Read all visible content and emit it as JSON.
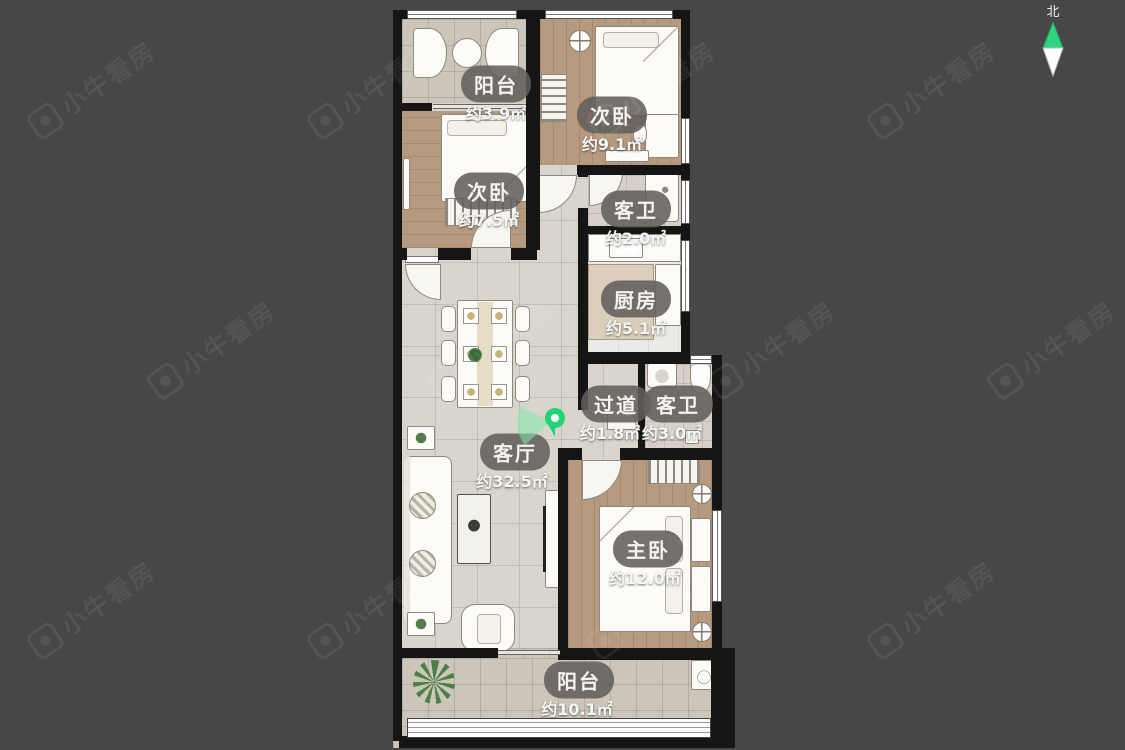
{
  "app": {
    "watermark_text": "小牛看房",
    "north_label": "北"
  },
  "rooms": {
    "balcony_top": {
      "label": "阳台",
      "area": "约3.9㎡"
    },
    "bedroom_top": {
      "label": "次卧",
      "area": "约9.1㎡"
    },
    "bedroom_left": {
      "label": "次卧",
      "area": "约7.5㎡"
    },
    "bath_top": {
      "label": "客卫",
      "area": "约2.0㎡"
    },
    "kitchen": {
      "label": "厨房",
      "area": "约5.1㎡"
    },
    "hallway": {
      "label": "过道",
      "area": "约1.8㎡"
    },
    "bath_mid": {
      "label": "客卫",
      "area": "约3.0㎡"
    },
    "living": {
      "label": "客厅",
      "area": "约32.5㎡"
    },
    "master": {
      "label": "主卧",
      "area": "约12.0㎡"
    },
    "balcony_bottom": {
      "label": "阳台",
      "area": "约10.1㎡"
    }
  },
  "colors": {
    "background": "#474747",
    "wall": "#151515",
    "wood_floor": "#b69a7f",
    "tile_floor": "#d9d5cd",
    "label_pill": "rgba(98,95,91,0.88)",
    "accent_green": "#2ed47e",
    "pin_cone": "rgba(130,232,170,0.55)"
  }
}
